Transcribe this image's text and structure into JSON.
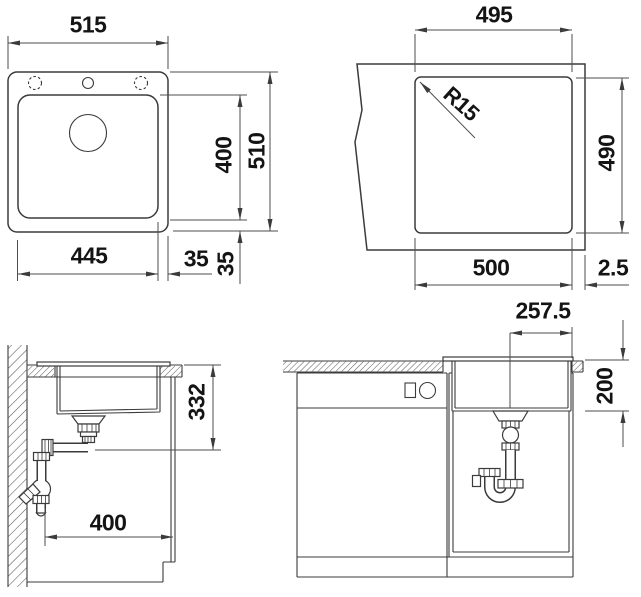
{
  "drawing": {
    "top_view": {
      "overall_width": "515",
      "bowl_width": "445",
      "rim_right": "35",
      "rim_bottom": "35",
      "bowl_length": "400",
      "overall_depth": "510"
    },
    "cutout_view": {
      "width_top": "495",
      "corner_radius": "R15",
      "depth": "490",
      "width_bottom": "500",
      "edge_offset": "2.5"
    },
    "side_view": {
      "drain_height": "332",
      "min_cabinet_depth": "400"
    },
    "front_view": {
      "drain_offset": "257.5",
      "bowl_depth": "200"
    }
  }
}
